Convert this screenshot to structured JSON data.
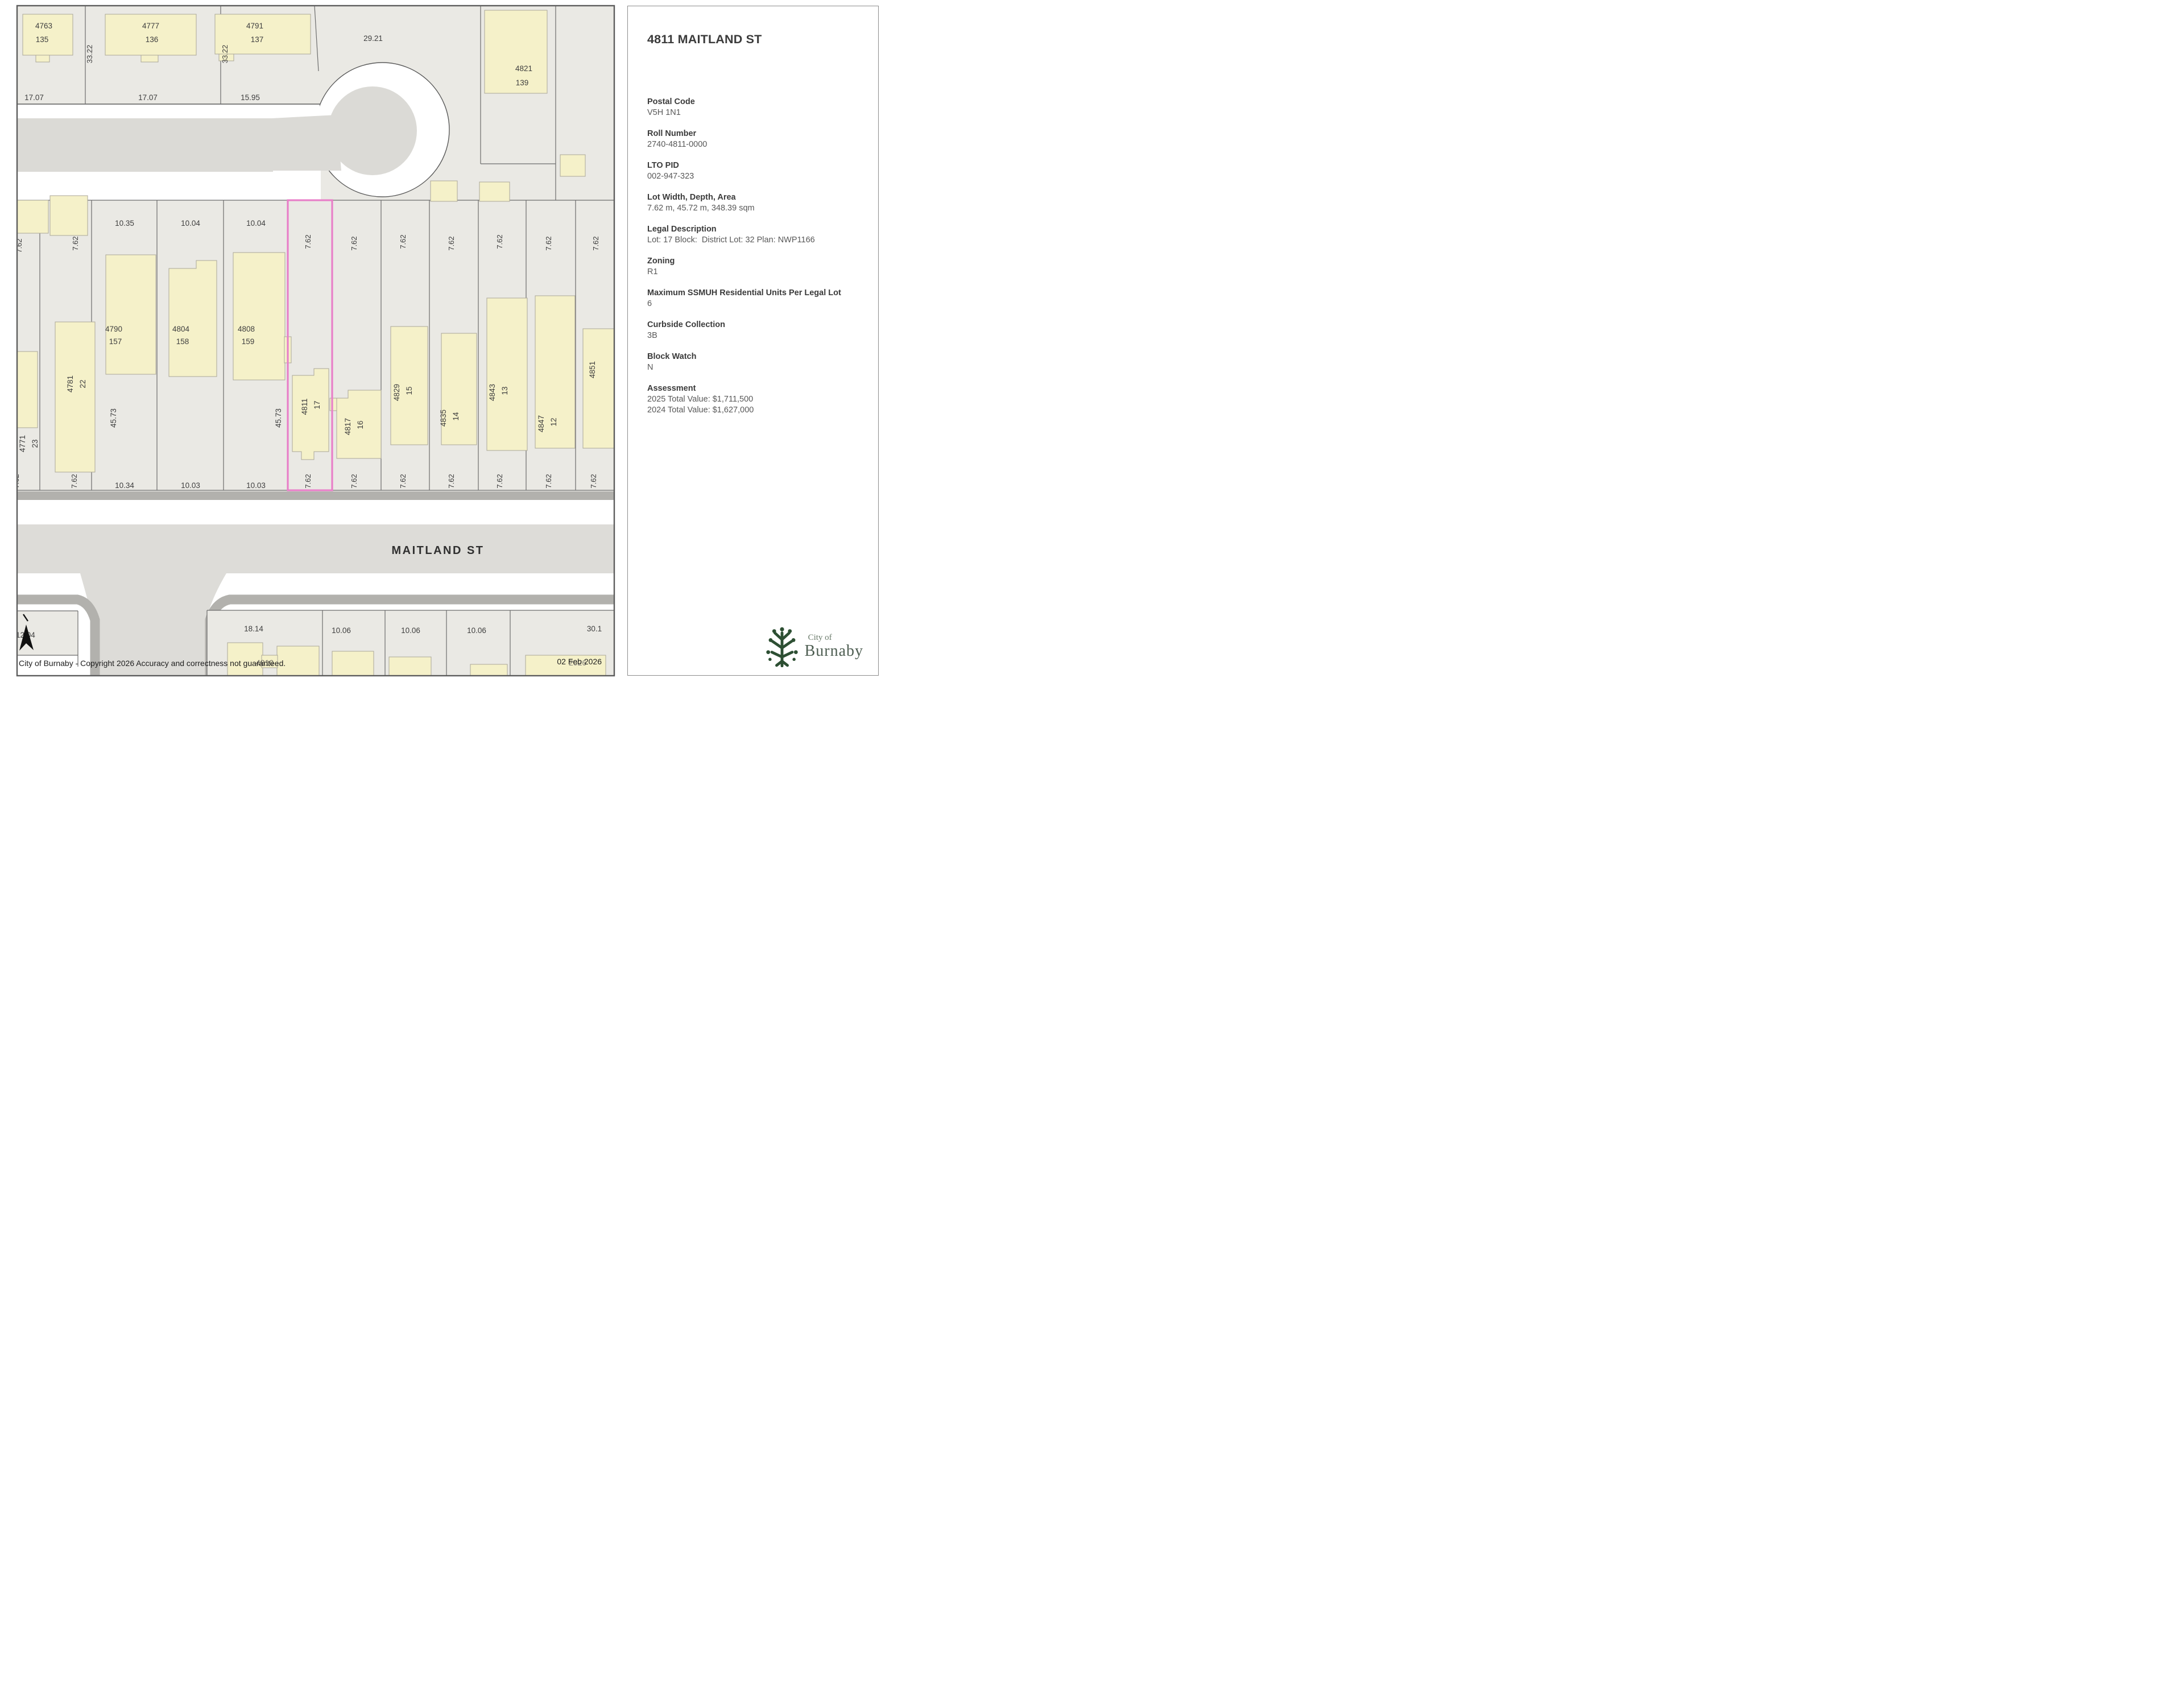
{
  "map": {
    "street_label": "MAITLAND ST",
    "copyright": "City of Burnaby - Copyright 2026 Accuracy and correctness not guaranteed.",
    "date": "02 Feb 2026",
    "date_ghost": "2026",
    "culdesac_dim": "29.21",
    "north_lots": [
      {
        "addr": "4763",
        "lot": "135",
        "front": "17.07",
        "side": "33.22"
      },
      {
        "addr": "4777",
        "lot": "136",
        "front": "17.07",
        "side": "33.22"
      },
      {
        "addr": "4791",
        "lot": "137",
        "front": "15.95"
      }
    ],
    "east_lot": {
      "addr": "4821",
      "lot": "139"
    },
    "depth_dim": "45.73",
    "mid_lots": [
      {
        "addr": "4771",
        "lot": "23",
        "top": "7.62",
        "bottom": "7.62"
      },
      {
        "addr": "4781",
        "lot": "22",
        "top": "7.62",
        "bottom": "7.62"
      },
      {
        "addr": "4790",
        "lot": "157",
        "top": "10.35",
        "bottom": "10.34"
      },
      {
        "addr": "4804",
        "lot": "158",
        "top": "10.04",
        "bottom": "10.03"
      },
      {
        "addr": "4808",
        "lot": "159",
        "top": "10.04",
        "bottom": "10.03"
      },
      {
        "addr": "4811",
        "lot": "17",
        "top": "7.62",
        "bottom": "7.62"
      },
      {
        "addr": "4817",
        "lot": "16",
        "top": "7.62",
        "bottom": "7.62"
      },
      {
        "addr": "4829",
        "lot": "15",
        "top": "7.62",
        "bottom": "7.62"
      },
      {
        "addr": "4835",
        "lot": "14",
        "top": "7.62",
        "bottom": "7.62"
      },
      {
        "addr": "4843",
        "lot": "13",
        "top": "7.62",
        "bottom": "7.62"
      },
      {
        "addr": "4847",
        "lot": "12",
        "top": "7.62",
        "bottom": "7.62"
      },
      {
        "addr": "4851",
        "lot": "",
        "top": "7.62",
        "bottom": "7.62"
      }
    ],
    "south_lots": [
      {
        "dim": "12.04"
      },
      {
        "dim": "18.14",
        "addr": "4810"
      },
      {
        "dim": "10.06"
      },
      {
        "dim": "10.06"
      },
      {
        "dim": "10.06"
      },
      {
        "dim": "30.1"
      }
    ]
  },
  "panel": {
    "title": "4811 MAITLAND ST",
    "fields": [
      {
        "label": "Postal Code",
        "value": "V5H 1N1"
      },
      {
        "label": "Roll Number",
        "value": "2740-4811-0000"
      },
      {
        "label": "LTO PID",
        "value": "002-947-323"
      },
      {
        "label": "Lot Width, Depth, Area",
        "value": "7.62 m, 45.72 m, 348.39 sqm"
      },
      {
        "label": "Legal Description",
        "value": "Lot: 17 Block:  District Lot: 32 Plan: NWP1166"
      },
      {
        "label": "Zoning",
        "value": "R1"
      },
      {
        "label": "Maximum SSMUH Residential Units Per Legal Lot",
        "value": "6"
      },
      {
        "label": "Curbside Collection",
        "value": "3B"
      },
      {
        "label": "Block Watch",
        "value": "N"
      },
      {
        "label": "Assessment",
        "value": "2025 Total Value: $1,711,500",
        "value2": "2024 Total Value: $1,627,000"
      }
    ],
    "logo": {
      "line1": "City of",
      "line2": "Burnaby"
    }
  },
  "colors": {
    "selected_outline": "#e87fc8",
    "building_fill": "#f5f1c9",
    "land": "#eae9e4",
    "road_surface": "#dbdad6",
    "curb": "#b2b1ad",
    "logo_green": "#2d4f33"
  }
}
